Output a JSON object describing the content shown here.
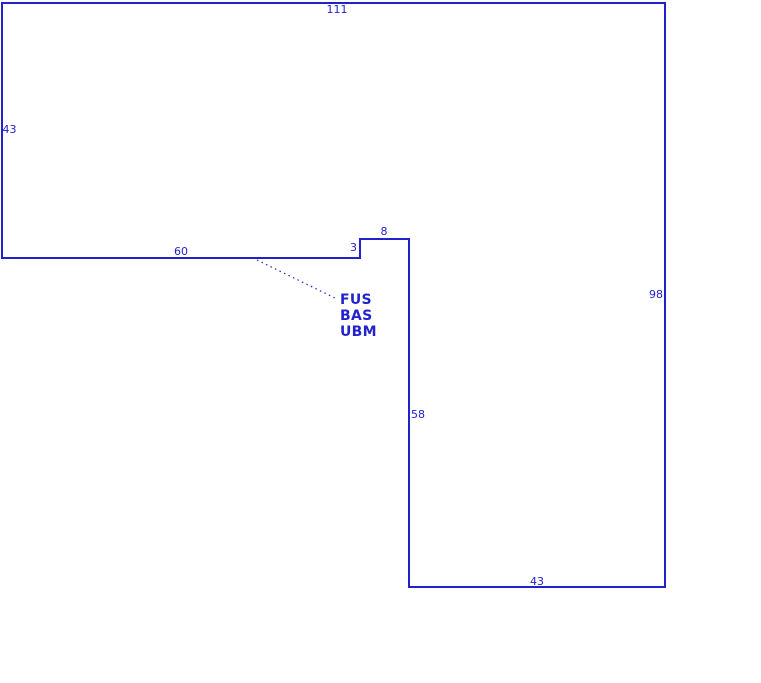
{
  "drawing": {
    "type": "outline-dimension-drawing",
    "background_color": "#ffffff",
    "line_color": "#2222cc",
    "text_color": "#2222cc",
    "dimensions": {
      "top_width": "111",
      "left_height": "43",
      "lower_left_width": "60",
      "step_height": "3",
      "step_width": "8",
      "right_height": "98",
      "inner_height": "58",
      "bottom_width": "43"
    },
    "annotation": {
      "line1": "FUS",
      "line2": "BAS",
      "line3": "UBM"
    }
  }
}
